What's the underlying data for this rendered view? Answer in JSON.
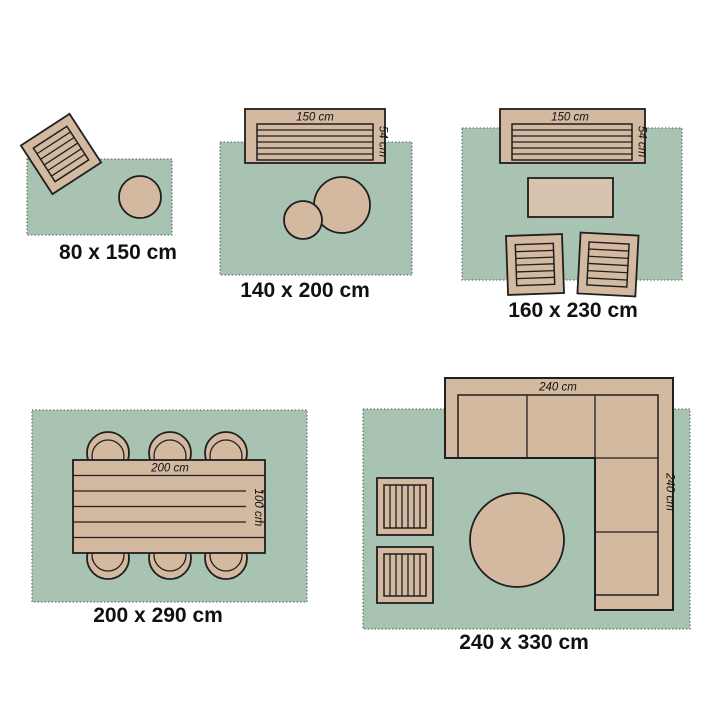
{
  "title": "Rug size guide with furniture layouts",
  "colors": {
    "background": "#ffffff",
    "rug": "#a8c3b1",
    "furniture": "#d3b9a0",
    "furniture_light": "#d8c3ae",
    "outline": "#1f1f1f",
    "text": "#111111"
  },
  "diagrams": [
    {
      "caption": "80 x 150 cm",
      "furniture": [
        "tilted-armchair",
        "round-ottoman"
      ]
    },
    {
      "caption": "140 x 200 cm",
      "sofa_width_label": "150 cm",
      "sofa_depth_label": "54 cm",
      "furniture": [
        "slatted-bench-sofa",
        "round-ottoman-large",
        "round-ottoman-small"
      ]
    },
    {
      "caption": "160 x 230 cm",
      "sofa_width_label": "150 cm",
      "sofa_depth_label": "54 cm",
      "furniture": [
        "slatted-bench-sofa",
        "coffee-table",
        "armchair-left",
        "armchair-right"
      ]
    },
    {
      "caption": "200 x 290 cm",
      "table_width_label": "200 cm",
      "table_depth_label": "100 cm",
      "furniture": [
        "dining-table",
        "chair-x6"
      ]
    },
    {
      "caption": "240 x 330 cm",
      "sofa_width_label": "240 cm",
      "sofa_depth_label": "240 cm",
      "furniture": [
        "corner-sofa",
        "side-table-upper",
        "side-table-lower",
        "round-table"
      ]
    }
  ]
}
